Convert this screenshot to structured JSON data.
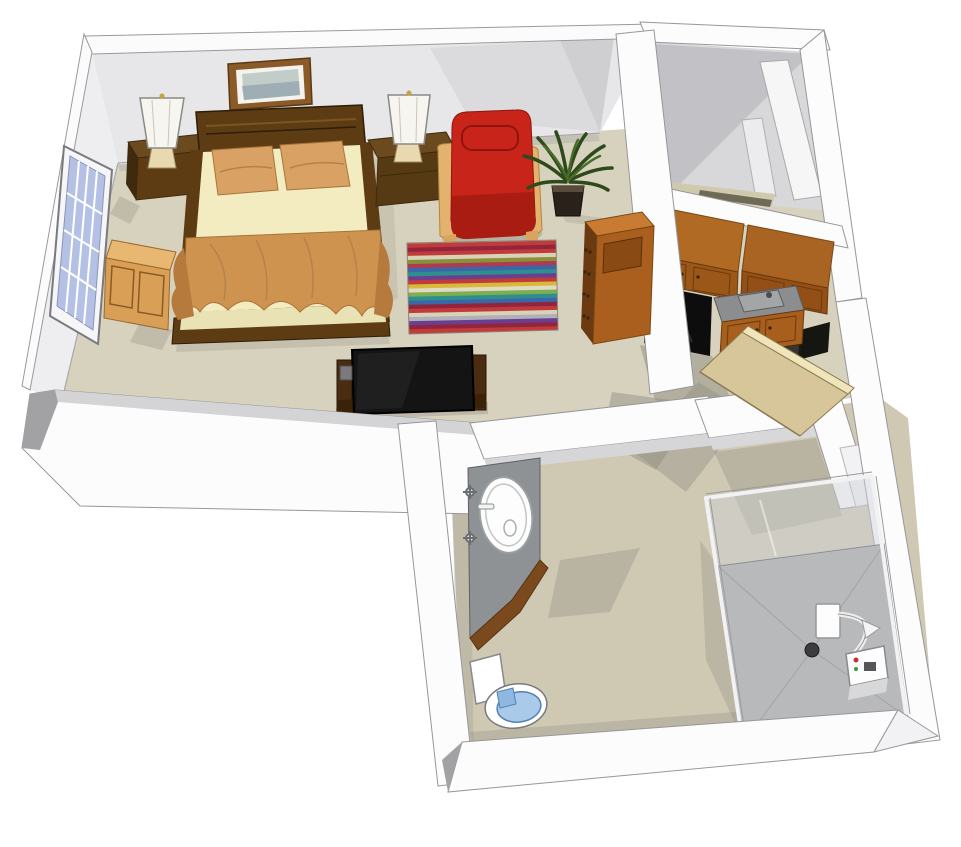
{
  "scene": {
    "name": "3D isometric apartment floor plan rendering",
    "style": "sketchup-like cutaway dollhouse view",
    "rooms": [
      {
        "label": "bedroom-living-area"
      },
      {
        "label": "closet"
      },
      {
        "label": "kitchenette"
      },
      {
        "label": "hallway"
      },
      {
        "label": "bathroom"
      }
    ],
    "furniture": [
      "framed-picture",
      "table-lamp-left",
      "table-lamp-right",
      "nightstand-left",
      "nightstand-right",
      "double-bed",
      "window",
      "window-bench",
      "red-armchair",
      "potted-plant",
      "striped-rug",
      "tv-on-stand",
      "bookshelf",
      "upper-cabinets",
      "refrigerator",
      "kitchen-sink-counter",
      "lower-cabinets",
      "entry-door",
      "bathroom-vanity",
      "toilet",
      "shower-enclosure"
    ]
  },
  "colors": {
    "bg": "#ffffff",
    "floor": "#d7d2bd",
    "floor_bath": "#cfc9b4",
    "floor_shadow": "#8f8c7f",
    "wall_white": "#fcfcfd",
    "wall_top": "#fbfbfc",
    "wall_face": "#e7e7e9",
    "wall_face_lit": "#eeeef0",
    "wall_face_dark": "#c2c2c6",
    "wall_cap": "#a2a2a5",
    "closet_floor": "#cfc9ae",
    "closet_dark_strip": "#6e6a55",
    "wood_dark": "#5d3c14",
    "wood_darker": "#3f2a0e",
    "mattress": "#f3ecc0",
    "pillow": "#d9a264",
    "blanket": "#cf9350",
    "blanket_dark": "#b57a3c",
    "chair_red": "#c8241a",
    "chair_red_dark": "#a81c12",
    "wood_light": "#e3b36e",
    "bench_top": "#e8b872",
    "bench_front": "#d99f56",
    "plant_green": "#2e4a1c",
    "plant_green_lit": "#486b28",
    "pot": "#2a211a",
    "window_glass": "#b4c0e4",
    "picture_frame": "#8a5a28",
    "picture_sky": "#c2ccc8",
    "picture_land": "#98a8b0",
    "cab_top": "#b06a24",
    "cab_top2": "#a96322",
    "cab_front": "#9a5717",
    "cab_front2": "#934f15",
    "counter": "#8b8d8f",
    "sink_metal": "#a3a5a7",
    "appliance_black": "#0d0d0d",
    "door_face": "#d8c69b",
    "door_edge": "#efe4ba",
    "vanity_top": "#8e9294",
    "vanity_wood": "#7a4a1e",
    "toilet_seat": "#a9cbe9",
    "shower_pan": "#b8b9bb",
    "glass": "#cdd0d4",
    "tv_screen": "#141414",
    "tv_wood": "#4a2d10",
    "shelf_front": "#ab5f1e",
    "shelf_top": "#c87c33",
    "shelf_side": "#6b3a10"
  },
  "rug": {
    "stripes": [
      "#c9c3a8",
      "#c23b3b",
      "#93243d",
      "#c23b3b",
      "#d8d3b8",
      "#8a8f3a",
      "#b03a50",
      "#3c66a6",
      "#2f8f8f",
      "#6a3f8f",
      "#c23b3b",
      "#d8b93a",
      "#e0dbc6",
      "#7fae4e",
      "#2f8f8f",
      "#3c66a6",
      "#93243d",
      "#c23b3b",
      "#d8d3b8",
      "#b0b0b8",
      "#6a3f8f",
      "#93243d",
      "#c23b3b",
      "#b03a50"
    ]
  }
}
